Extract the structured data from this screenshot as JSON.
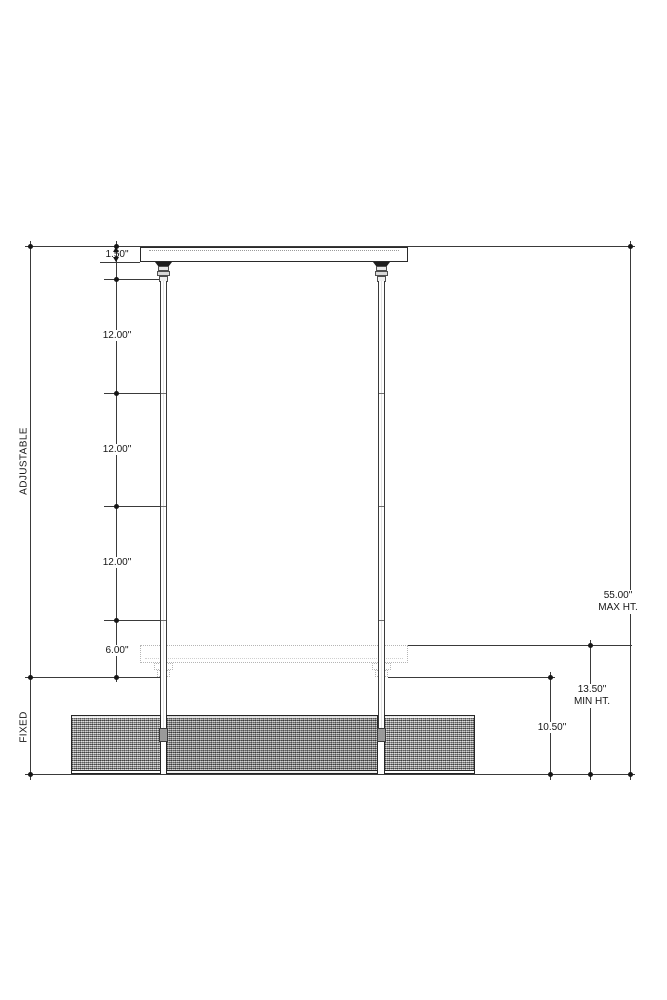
{
  "side_labels": {
    "adjustable": "ADJUSTABLE",
    "fixed": "FIXED"
  },
  "dimensions": {
    "canopy_height": "1.50\"",
    "segments": [
      "12.00\"",
      "12.00\"",
      "12.00\"",
      "6.00\""
    ],
    "max_height": {
      "value": "55.00\"",
      "label": "MAX HT."
    },
    "min_height": {
      "value": "13.50\"",
      "label": "MIN HT."
    },
    "fixed_height": "10.50\""
  },
  "colors": {
    "ink": "#161616",
    "line": "#3a3a3a",
    "ghost": "#b5b5b5"
  }
}
